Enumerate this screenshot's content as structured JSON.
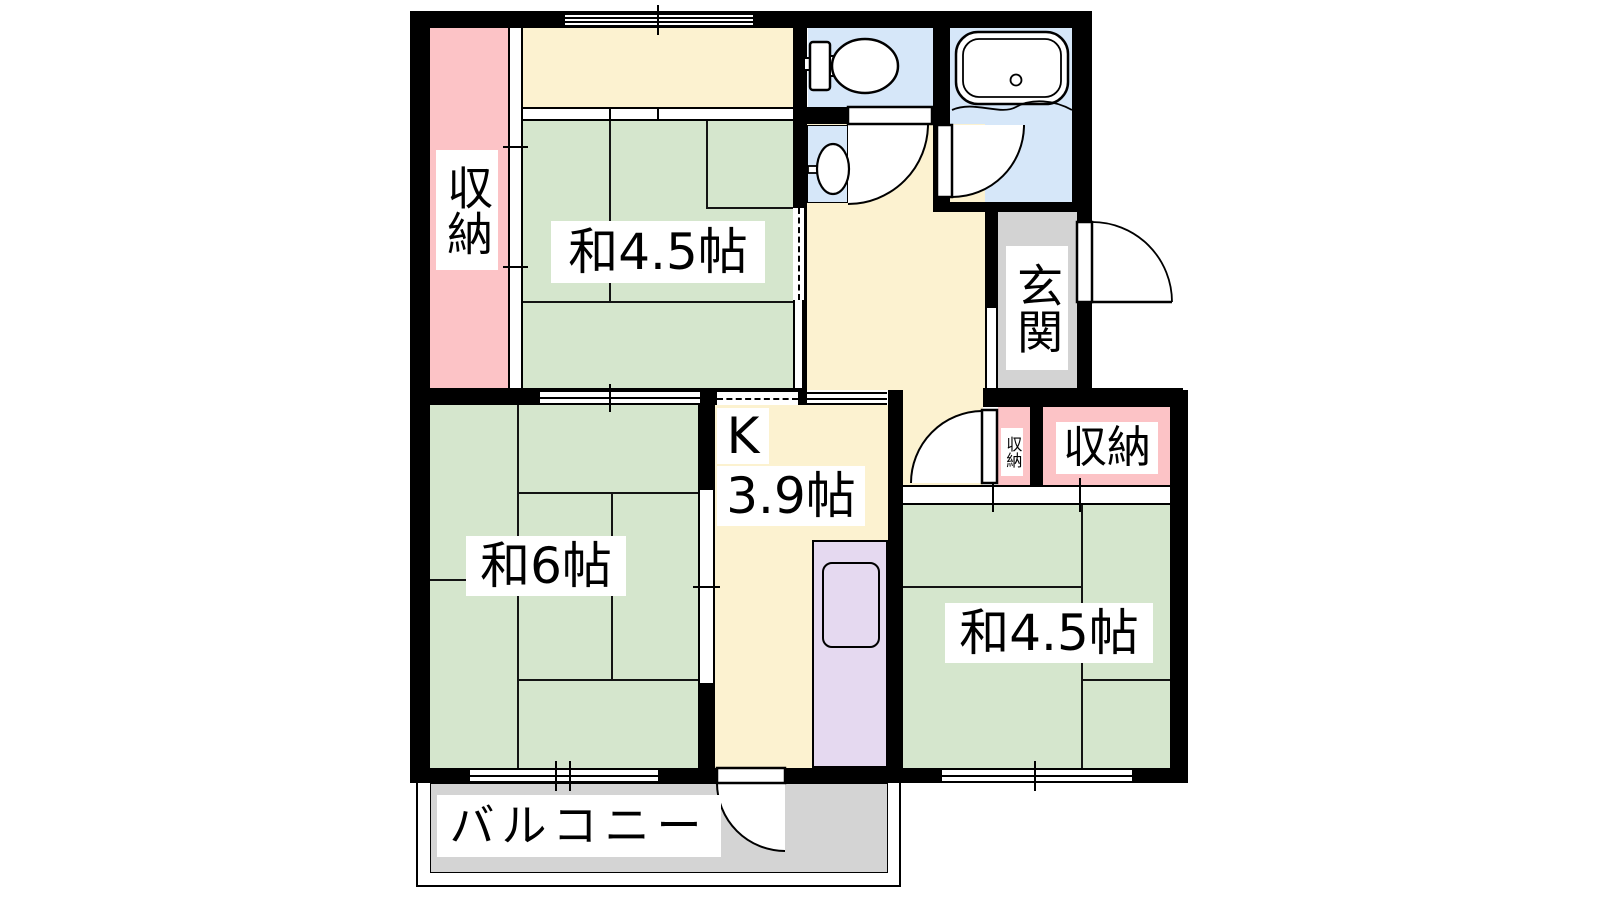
{
  "labels": {
    "closet_left": "収納",
    "room_a": "和4.5帖",
    "room_b": "和6帖",
    "kitchen_letter": "K",
    "kitchen_size": "3.9帖",
    "room_c": "和4.5帖",
    "entrance": "玄関",
    "closet_small": "収納",
    "closet_right": "収納",
    "balcony": "バルコニー"
  },
  "colors": {
    "wall": "#000000",
    "tatami": "#d5e6cd",
    "hall": "#fcf2d0",
    "closet": "#fcc3c6",
    "water": "#d6e7f9",
    "entry": "#d3d3d3",
    "balcony": "#d4d4d4",
    "kitchen_unit": "#e5d9f0"
  }
}
